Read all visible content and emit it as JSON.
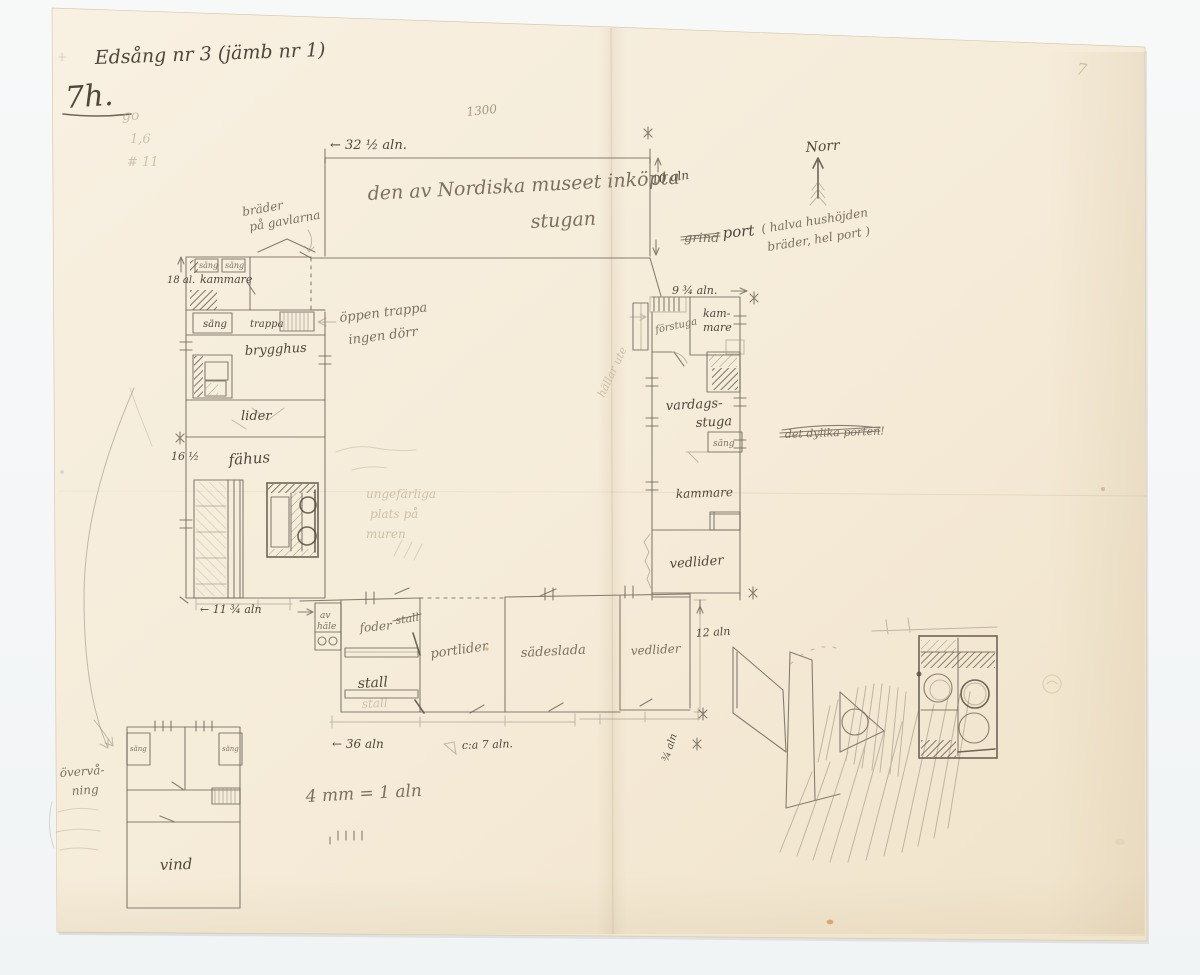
{
  "header": {
    "title": "Edsång nr 3 (jämb nr 1)",
    "monogram": "7h.",
    "faint_figure_1": "go",
    "faint_figure_2": "1,6",
    "faint_figure_3": "# 11",
    "plate_number": "1300",
    "page_number": "7"
  },
  "compass": {
    "north_label": "Norr"
  },
  "main_building": {
    "label_line1": "den av Nordiska museet inköpta",
    "label_line2": "stugan",
    "width_dim": "← 32 ½ aln.",
    "depth_dim": "10 aln",
    "gable_note_line1": "bräder",
    "gable_note_line2": "på gavlarna"
  },
  "west_wing": {
    "kammare": "kammare",
    "sang_small": "säng",
    "sang": "säng",
    "trappa": "trappa",
    "brygghus": "brygghus",
    "lider": "lider",
    "fahus": "fähus",
    "height_dim": "18 al.",
    "fahus_dim": "16 ½",
    "bottom_dim": "← 11 ¾ aln",
    "stair_note_line1": "öppen trappa",
    "stair_note_line2": "ingen dörr"
  },
  "east_wing": {
    "top_dim": "9 ¾ aln.",
    "forstuga": "förstuga",
    "kammare_line1": "kam-",
    "kammare_line2": "mare",
    "vardagsstuga_line1": "vardags-",
    "vardagsstuga_line2": "stuga",
    "sang": "säng",
    "kammare_south": "kammare",
    "vedlider": "vedlider",
    "port_struck": "grind",
    "port": "port",
    "port_note_line1": "( halva hushöjden",
    "port_note_line2": "bräder, hel port )",
    "struck_note": "det dylika porten!",
    "wall_note": "hällar ute"
  },
  "south_row": {
    "hay_hatch_line1": "av",
    "hay_hatch_line2": "häle",
    "foder": "foder",
    "foder_struck": "stall",
    "stall": "stall",
    "portlider": "portlider",
    "sadeslada": "sädeslada",
    "vedlider": "vedlider",
    "length_dim": "← 36 aln",
    "circa_dim": "c:a 7 aln.",
    "side_dim": "12 aln",
    "gap_dim": "¾ aln"
  },
  "upper_floor": {
    "note_line1": "övervå-",
    "note_line2": "ning",
    "sang": "säng",
    "vind": "vind"
  },
  "scale_note": {
    "text": "4 mm = 1 aln"
  },
  "erased_notes": {
    "line1": "ungefärliga",
    "line2": "plats på",
    "line3": "muren"
  }
}
